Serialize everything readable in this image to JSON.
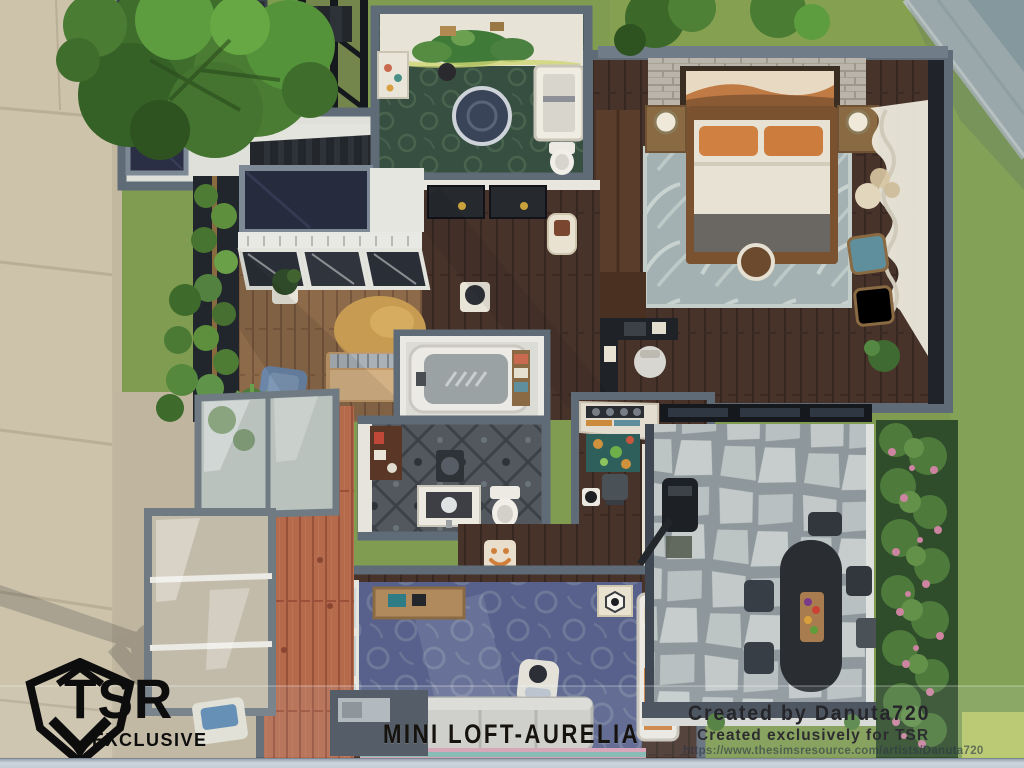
{
  "branding": {
    "logo_text": "TSR",
    "logo_subtext": "EXCLUSIVE",
    "logo_icon": "tsr-diamond-icon",
    "logo_color": "#0d0d0d"
  },
  "caption": {
    "title": "MINI LOFT-AURELIA"
  },
  "credits": {
    "created_by": "Created by Danuta720",
    "exclusive": "Created exclusively for TSR",
    "url": "https://www.thesimsresource.com/artists/Danuta720"
  },
  "palette": {
    "wall_gray": "#5f6b77",
    "trim_white": "#eceae4",
    "wood_dark": "#47332a",
    "wood_warm": "#8d6a49",
    "deck_terracotta": "#b56a4c",
    "rug_blue": "#57618c",
    "rug_bedroom": "#a3b1b2",
    "rug_gold": "#c79c52",
    "nursery_floor": "#364f40",
    "bath_tile": "#53585e",
    "patio_stone": "#c0c7c7",
    "grass": "#7f9c50",
    "sidewalk": "#cdc3ab",
    "hedge_flower": "#cc84a0",
    "accent_orange": "#d08040",
    "chair_teal": "#5f8f9c",
    "stairs_black": "#23262b",
    "bottom_bar": "#c5ced8"
  }
}
